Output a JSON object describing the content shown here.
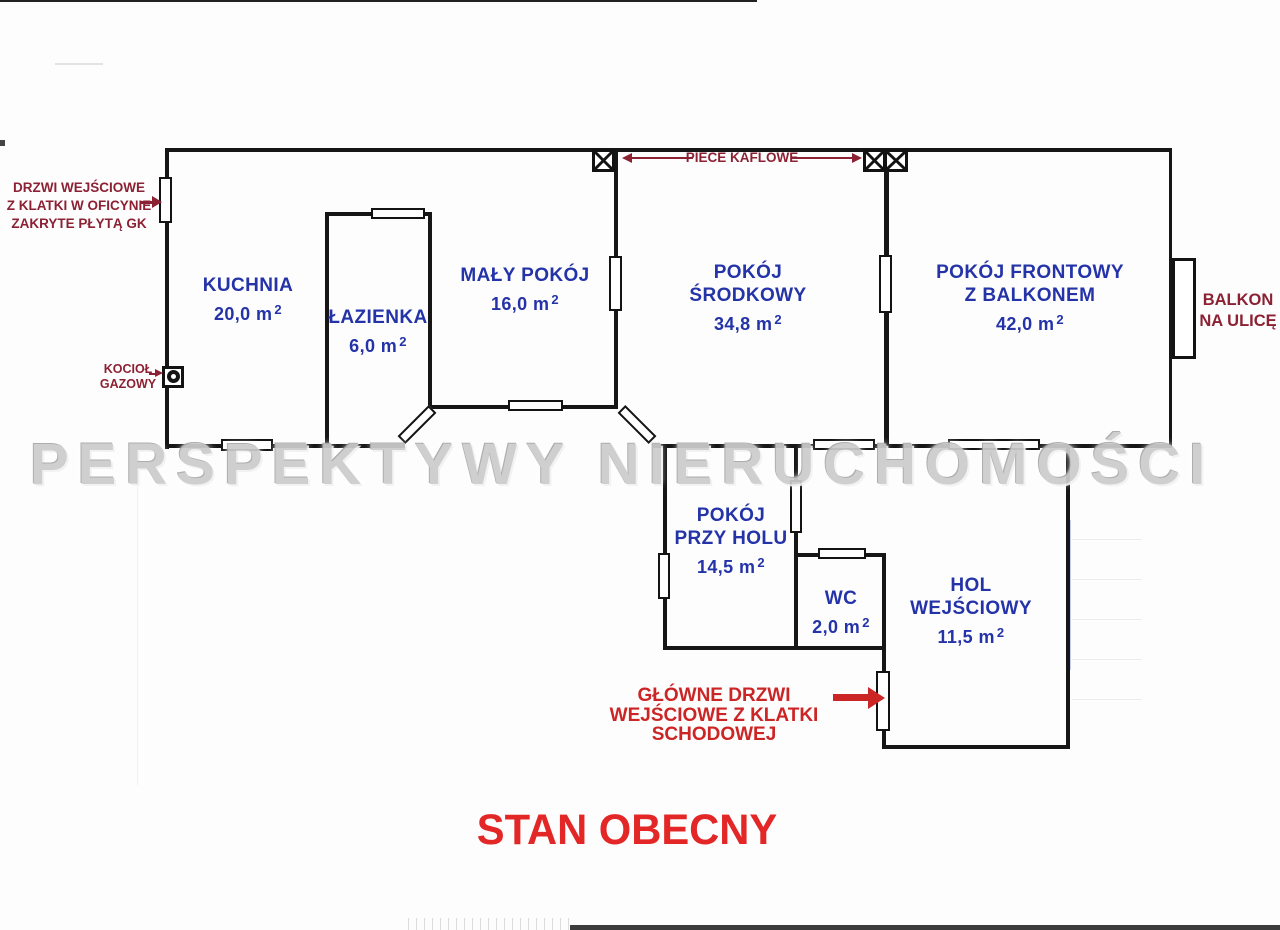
{
  "title": "STAN OBECNY",
  "watermark": "PERSPEKTYWY NIERUCHOMOŚCI",
  "colors": {
    "room_label_blue": "#2433a8",
    "annotation_maroon": "#8c2133",
    "annotation_red": "#cc2525",
    "title_red": "#e22726",
    "wall_black": "#161616",
    "watermark_gray": "#cccccc"
  },
  "rooms": [
    {
      "id": "kuchnia",
      "line1": "KUCHNIA",
      "area": "20,0 m",
      "sup": "2"
    },
    {
      "id": "lazienka",
      "line1": "ŁAZIENKA",
      "area": "6,0 m",
      "sup": "2"
    },
    {
      "id": "maly-pokoj",
      "line1": "MAŁY POKÓJ",
      "area": "16,0 m",
      "sup": "2"
    },
    {
      "id": "pokoj-srodkowy",
      "line1": "POKÓJ",
      "line2": "ŚRODKOWY",
      "area": "34,8 m",
      "sup": "2"
    },
    {
      "id": "pokoj-frontowy",
      "line1": "POKÓJ FRONTOWY",
      "line2": "Z BALKONEM",
      "area": "42,0 m",
      "sup": "2"
    },
    {
      "id": "pokoj-przy-holu",
      "line1": "POKÓJ",
      "line2": "PRZY HOLU",
      "area": "14,5 m",
      "sup": "2"
    },
    {
      "id": "wc",
      "line1": "WC",
      "area": "2,0 m",
      "sup": "2"
    },
    {
      "id": "hol-wejsciowy",
      "line1": "HOL",
      "line2": "WEJŚCIOWY",
      "area": "11,5 m",
      "sup": "2"
    }
  ],
  "annotations": {
    "entry_side": {
      "line1": "DRZWI WEJŚCIOWE",
      "line2": "Z KLATKI W OFICYNIE",
      "line3": "ZAKRYTE PŁYTĄ GK"
    },
    "boiler": {
      "line1": "KOCIOŁ",
      "line2": "GAZOWY"
    },
    "stoves": {
      "label": "PIECE KAFLOWE"
    },
    "balcony": {
      "line1": "BALKON",
      "line2": "NA ULICĘ"
    },
    "main_entry": {
      "line1": "GŁÓWNE DRZWI WEJŚCIOWE",
      "line2": "Z KLATKI SCHODOWEJ"
    }
  }
}
